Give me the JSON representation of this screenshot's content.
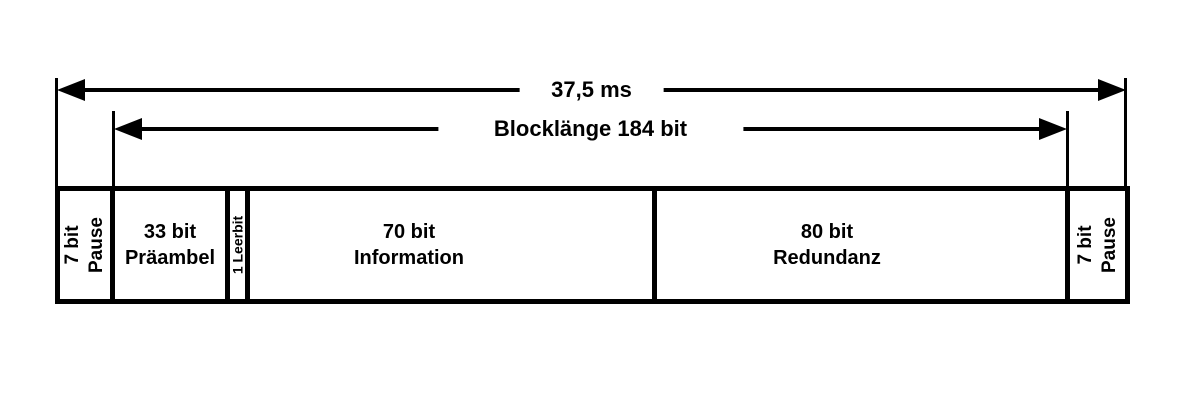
{
  "diagram": {
    "arrows": {
      "total": {
        "label": "37,5 ms"
      },
      "block": {
        "label": "Blocklänge 184 bit"
      }
    },
    "segments": {
      "pause_left": {
        "line1": "7 bit",
        "line2": "Pause"
      },
      "preamble": {
        "line1": "33 bit",
        "line2": "Präambel"
      },
      "leerbit": {
        "label": "1 Leerbit"
      },
      "information": {
        "line1": "70 bit",
        "line2": "Information"
      },
      "redundancy": {
        "line1": "80 bit",
        "line2": "Redundanz"
      },
      "pause_right": {
        "line1": "7 bit",
        "line2": "Pause"
      }
    },
    "colors": {
      "ink": "#000000",
      "background": "#ffffff"
    }
  }
}
